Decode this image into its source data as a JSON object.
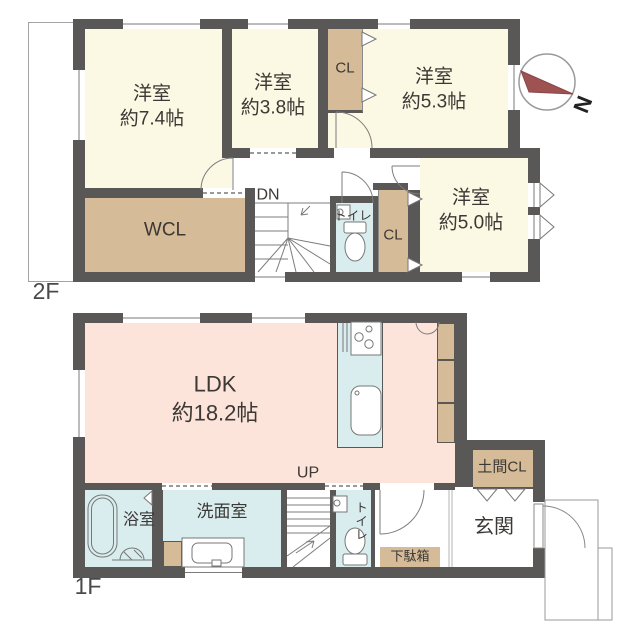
{
  "title": "2-story house floor plan",
  "compass": {
    "north": "N"
  },
  "colors": {
    "wall": "#5a5757",
    "room_cream": "#fbf8e3",
    "closet_tan": "#d5bb97",
    "ldk_pink": "#fce4da",
    "wet_area_blue": "#d9edee",
    "compass_needle": "#9e5252"
  },
  "f2": {
    "floor_label": "2F",
    "room74_name": "洋室",
    "room74_area": "約7.4帖",
    "room38_name": "洋室",
    "room38_area": "約3.8帖",
    "cl_top": "CL",
    "room53_name": "洋室",
    "room53_area": "約5.3帖",
    "wcl": "WCL",
    "dn": "DN",
    "toilet": "トイレ",
    "cl_side": "CL",
    "room50_name": "洋室",
    "room50_area": "約5.0帖"
  },
  "f1": {
    "floor_label": "1F",
    "ldk_name": "LDK",
    "ldk_area": "約18.2帖",
    "up": "UP",
    "doma_cl": "土間CL",
    "bath": "浴室",
    "washroom": "洗面室",
    "toilet": "トイレ",
    "shoe_cabinet": "下駄箱",
    "entrance": "玄関"
  }
}
